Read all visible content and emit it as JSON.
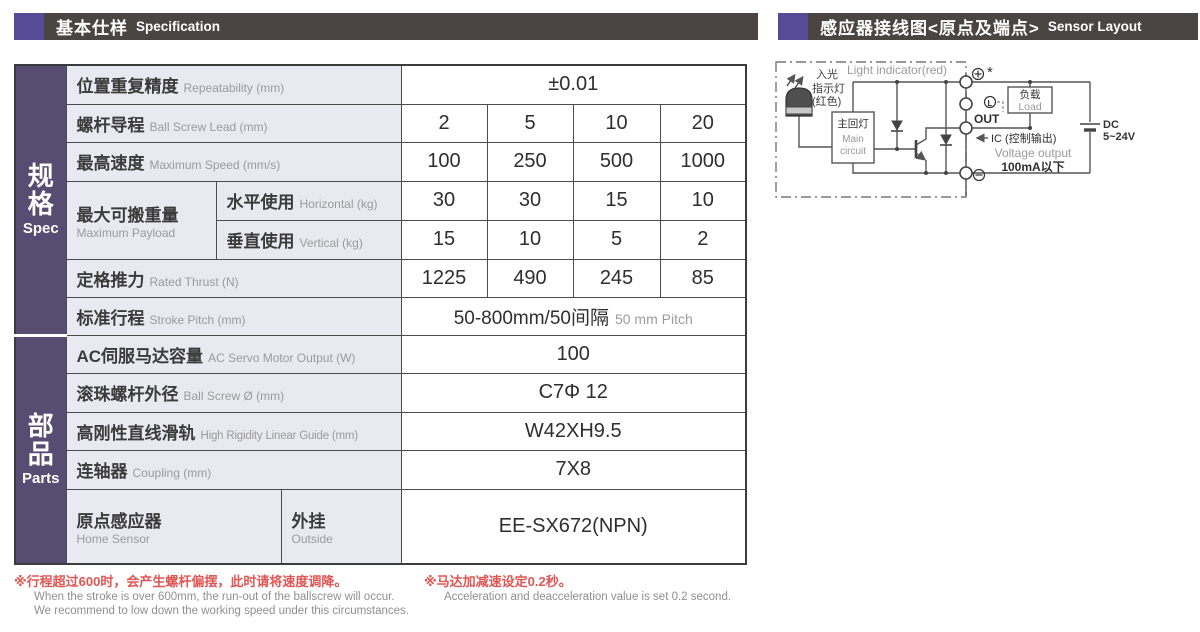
{
  "colors": {
    "accent_purple": "#574a96",
    "header_bar_gray": "#4a4442",
    "sidebar_purple": "#574d72",
    "label_cell_bg": "#e9e9f1",
    "note_red": "#e05654",
    "note_gray": "#8f8f8f"
  },
  "header_left": {
    "zh": "基本仕样",
    "en": "Specification"
  },
  "header_right": {
    "zh": "感应器接线图<原点及端点>",
    "en": "Sensor Layout"
  },
  "sidebar": {
    "spec_zh": "规格",
    "spec_en": "Spec",
    "parts_zh": "部品",
    "parts_en": "Parts"
  },
  "table": {
    "repeatability": {
      "zh": "位置重复精度",
      "en": "Repeatability (mm)",
      "value": "±0.01"
    },
    "ball_screw_lead": {
      "zh": "螺杆导程",
      "en": "Ball Screw Lead (mm)",
      "values": [
        "2",
        "5",
        "10",
        "20"
      ]
    },
    "max_speed": {
      "zh": "最高速度",
      "en": "Maximum Speed (mm/s)",
      "values": [
        "100",
        "250",
        "500",
        "1000"
      ]
    },
    "max_payload": {
      "zh": "最大可搬重量",
      "en": "Maximum Payload"
    },
    "horizontal": {
      "zh": "水平使用",
      "en": "Horizontal (kg)",
      "values": [
        "30",
        "30",
        "15",
        "10"
      ]
    },
    "vertical": {
      "zh": "垂直使用",
      "en": "Vertical (kg)",
      "values": [
        "15",
        "10",
        "5",
        "2"
      ]
    },
    "rated_thrust": {
      "zh": "定格推力",
      "en": "Rated Thrust (N)",
      "values": [
        "1225",
        "490",
        "245",
        "85"
      ]
    },
    "stroke": {
      "zh": "标准行程",
      "en": "Stroke Pitch (mm)",
      "value_zh": "50-800mm/50间隔",
      "value_en": "50 mm Pitch"
    },
    "servo_output": {
      "zh": "AC伺服马达容量",
      "en": "AC Servo Motor Output (W)",
      "value": "100"
    },
    "ball_screw_dia": {
      "zh": "滚珠螺杆外径",
      "en": "Ball Screw Ø (mm)",
      "value": "C7Φ 12"
    },
    "linear_guide": {
      "zh": "高刚性直线滑轨",
      "en": "High Rigidity Linear Guide (mm)",
      "value": "W42XH9.5"
    },
    "coupling": {
      "zh": "连轴器",
      "en": "Coupling (mm)",
      "value": "7X8"
    },
    "home_sensor": {
      "zh": "原点感应器",
      "en": "Home Sensor",
      "sub_zh": "外挂",
      "sub_en": "Outside",
      "value": "EE-SX672(NPN)"
    }
  },
  "notes": {
    "left_red": "※行程超过600时，会产生螺杆偏摆，此时请将速度调降。",
    "left_en1": "When the stroke is over 600mm, the run-out of the ballscrew will occur.",
    "left_en2": "We recommend to low down the working speed under this circumstances.",
    "right_red": "※马达加减速设定0.2秒。",
    "right_en": "Acceleration and deacceleration value is set 0.2 second."
  },
  "diagram": {
    "light_indicator": "Light indicator(red)",
    "led_label_1": "入光",
    "led_label_2": "指示灯",
    "led_label_3": "(红色)",
    "main_circuit_zh": "主回灯",
    "main_circuit_en_1": "Main",
    "main_circuit_en_2": "circuit",
    "terminal_plus_note": "*",
    "terminal_l": "L",
    "terminal_out": "OUT",
    "load_zh": "负载",
    "load_en": "Load",
    "ic_label": "IC (控制输出)",
    "voltage_output": "Voltage output",
    "current_limit": "100mA以下",
    "dc_line1": "DC",
    "dc_line2": "5~24V"
  }
}
